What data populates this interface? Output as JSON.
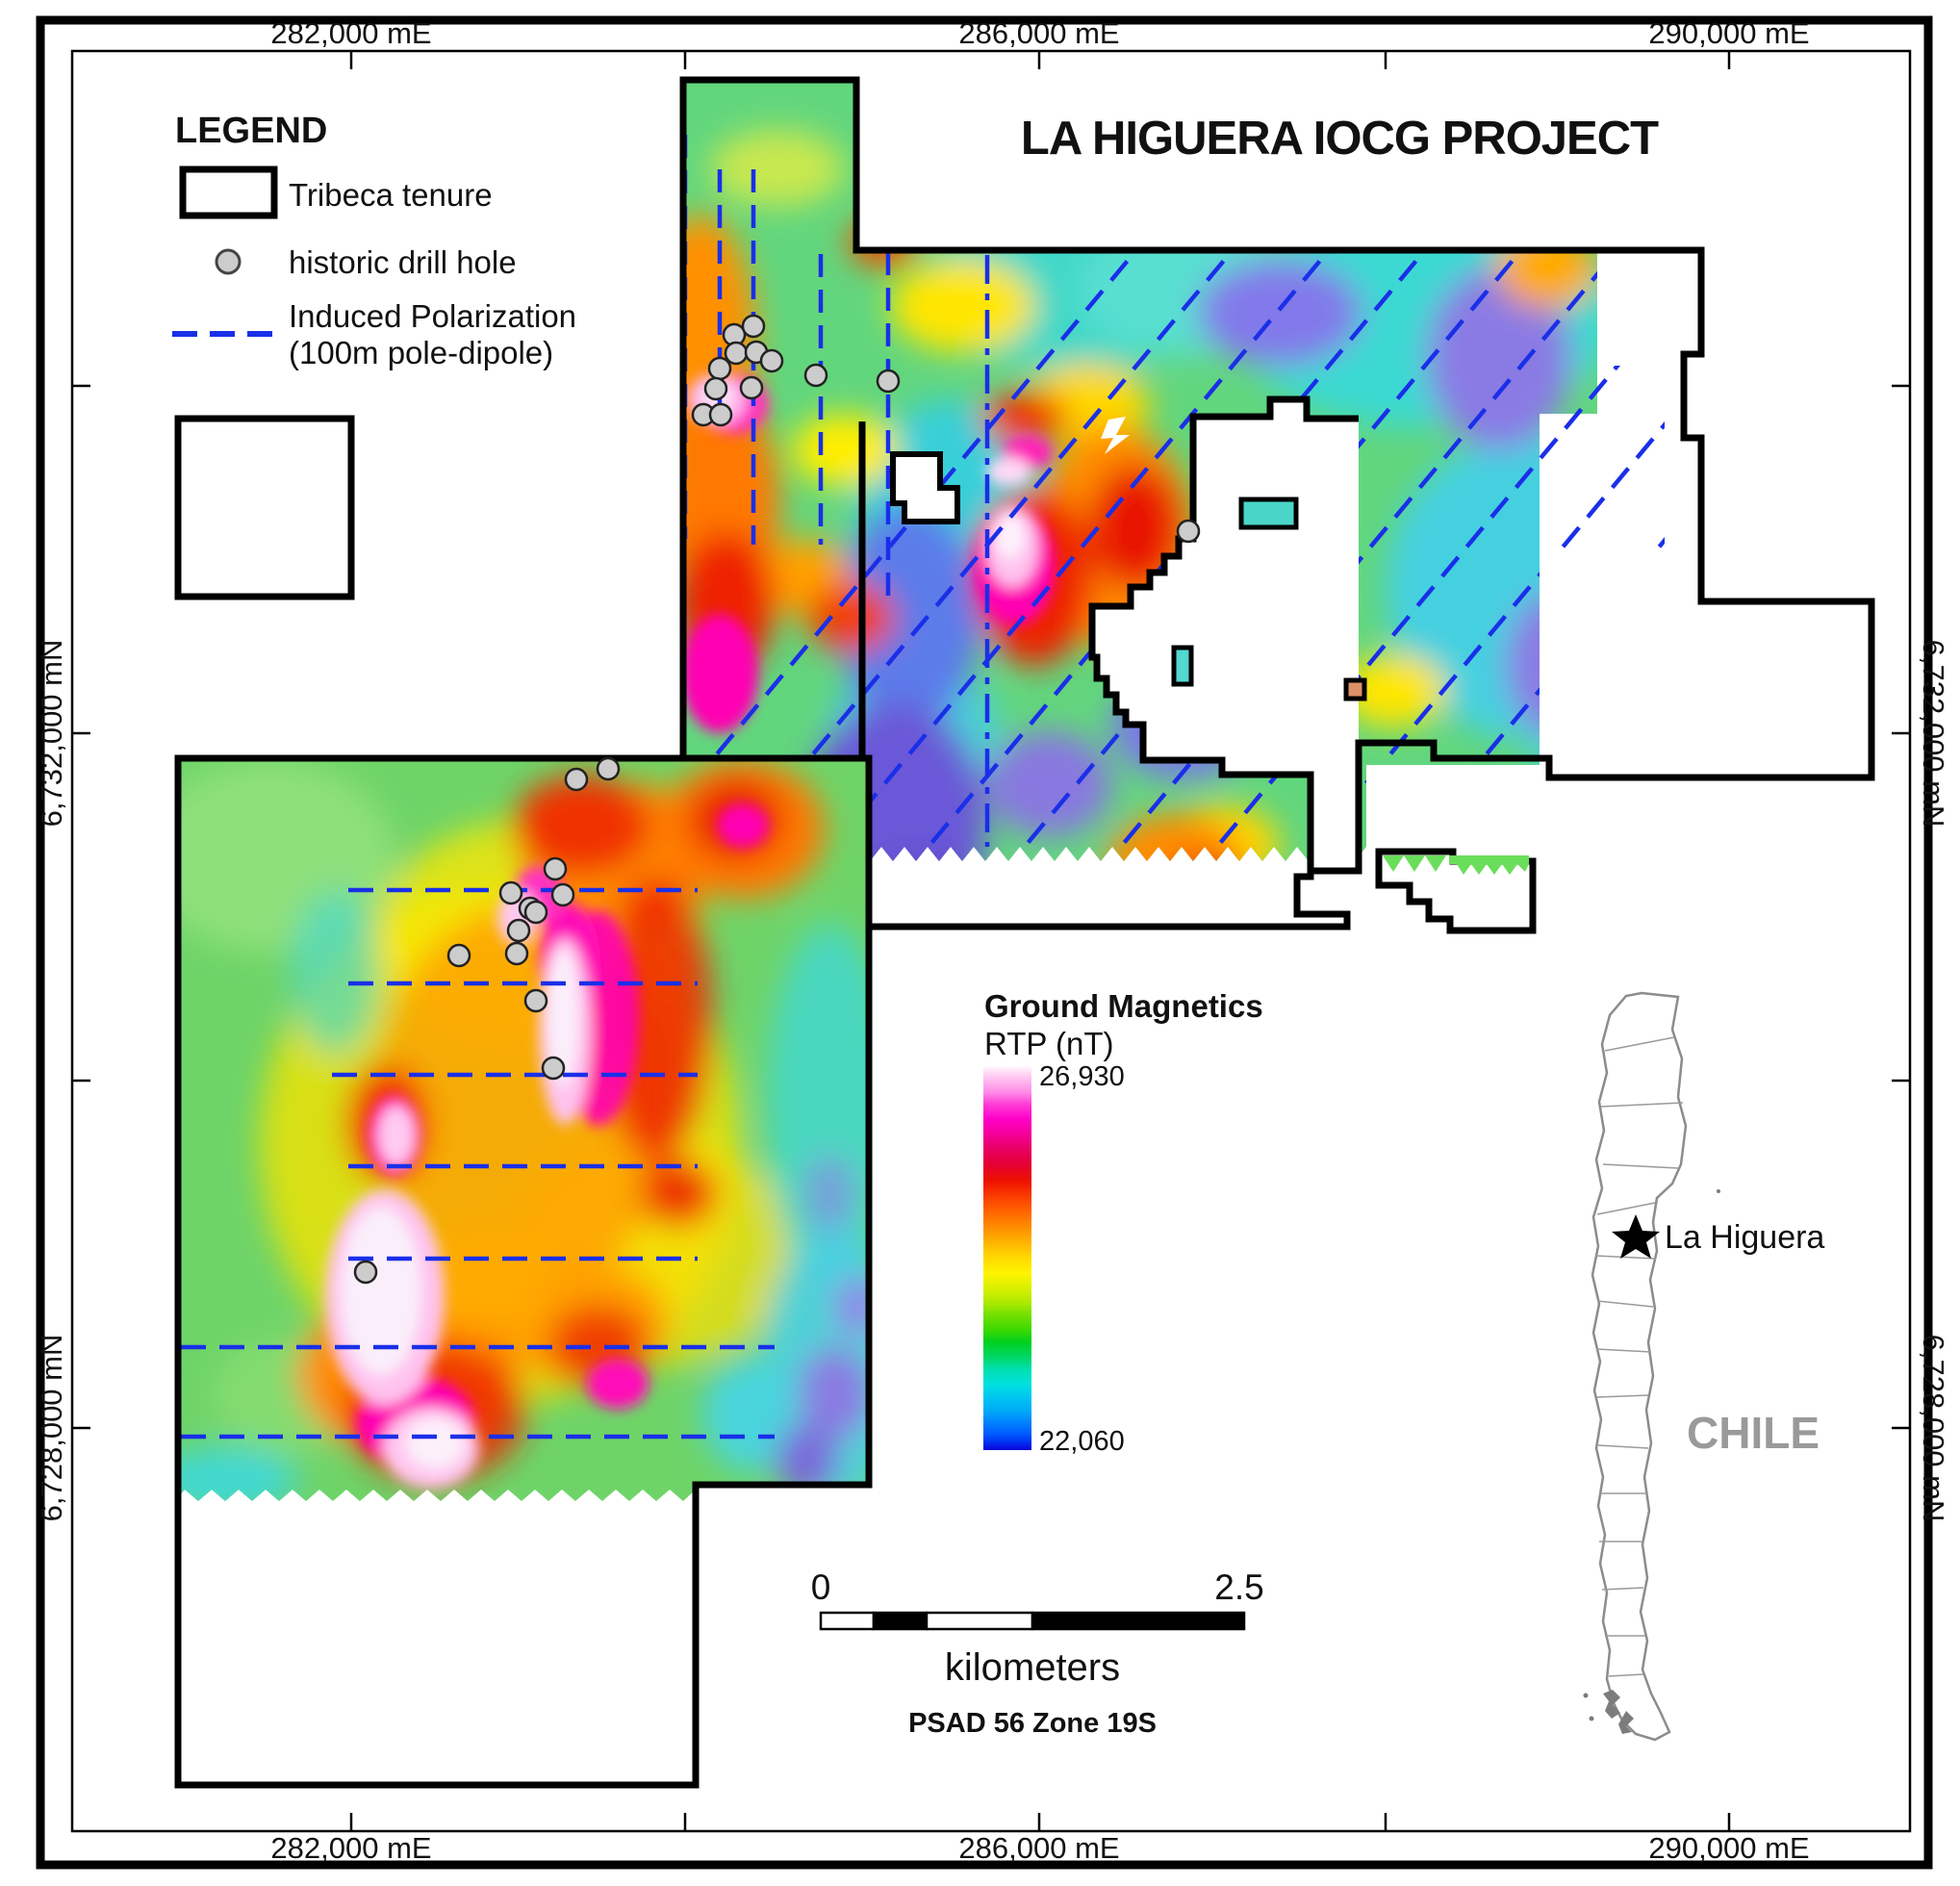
{
  "title": "LA HIGUERA IOCG PROJECT",
  "legend": {
    "heading": "LEGEND",
    "tenure_label": "Tribeca tenure",
    "drill_label": "historic drill hole",
    "ip_label_line1": "Induced Polarization",
    "ip_label_line2": "(100m pole-dipole)"
  },
  "axes": {
    "top": [
      "282,000 mE",
      "286,000 mE",
      "290,000 mE"
    ],
    "bottom": [
      "282,000 mE",
      "286,000 mE",
      "290,000 mE"
    ],
    "left": [
      "6,732,000 mN",
      "6,728,000 mN"
    ],
    "right": [
      "6,732,000 mN",
      "6,728,000 mN"
    ]
  },
  "colorbar": {
    "title": "Ground Magnetics",
    "subtitle": "RTP (nT)",
    "max": "26,930",
    "min": "22,060",
    "max_color": "#ffffff",
    "min_color": "#0b00d8"
  },
  "scalebar": {
    "start": "0",
    "end": "2.5",
    "units": "kilometers",
    "datum": "PSAD 56 Zone 19S"
  },
  "inset": {
    "place": "La Higuera",
    "country": "CHILE"
  },
  "colors": {
    "ip_line": "#1a2fe8",
    "drill_fill": "#cccccc",
    "tenure_stroke": "#000000"
  }
}
